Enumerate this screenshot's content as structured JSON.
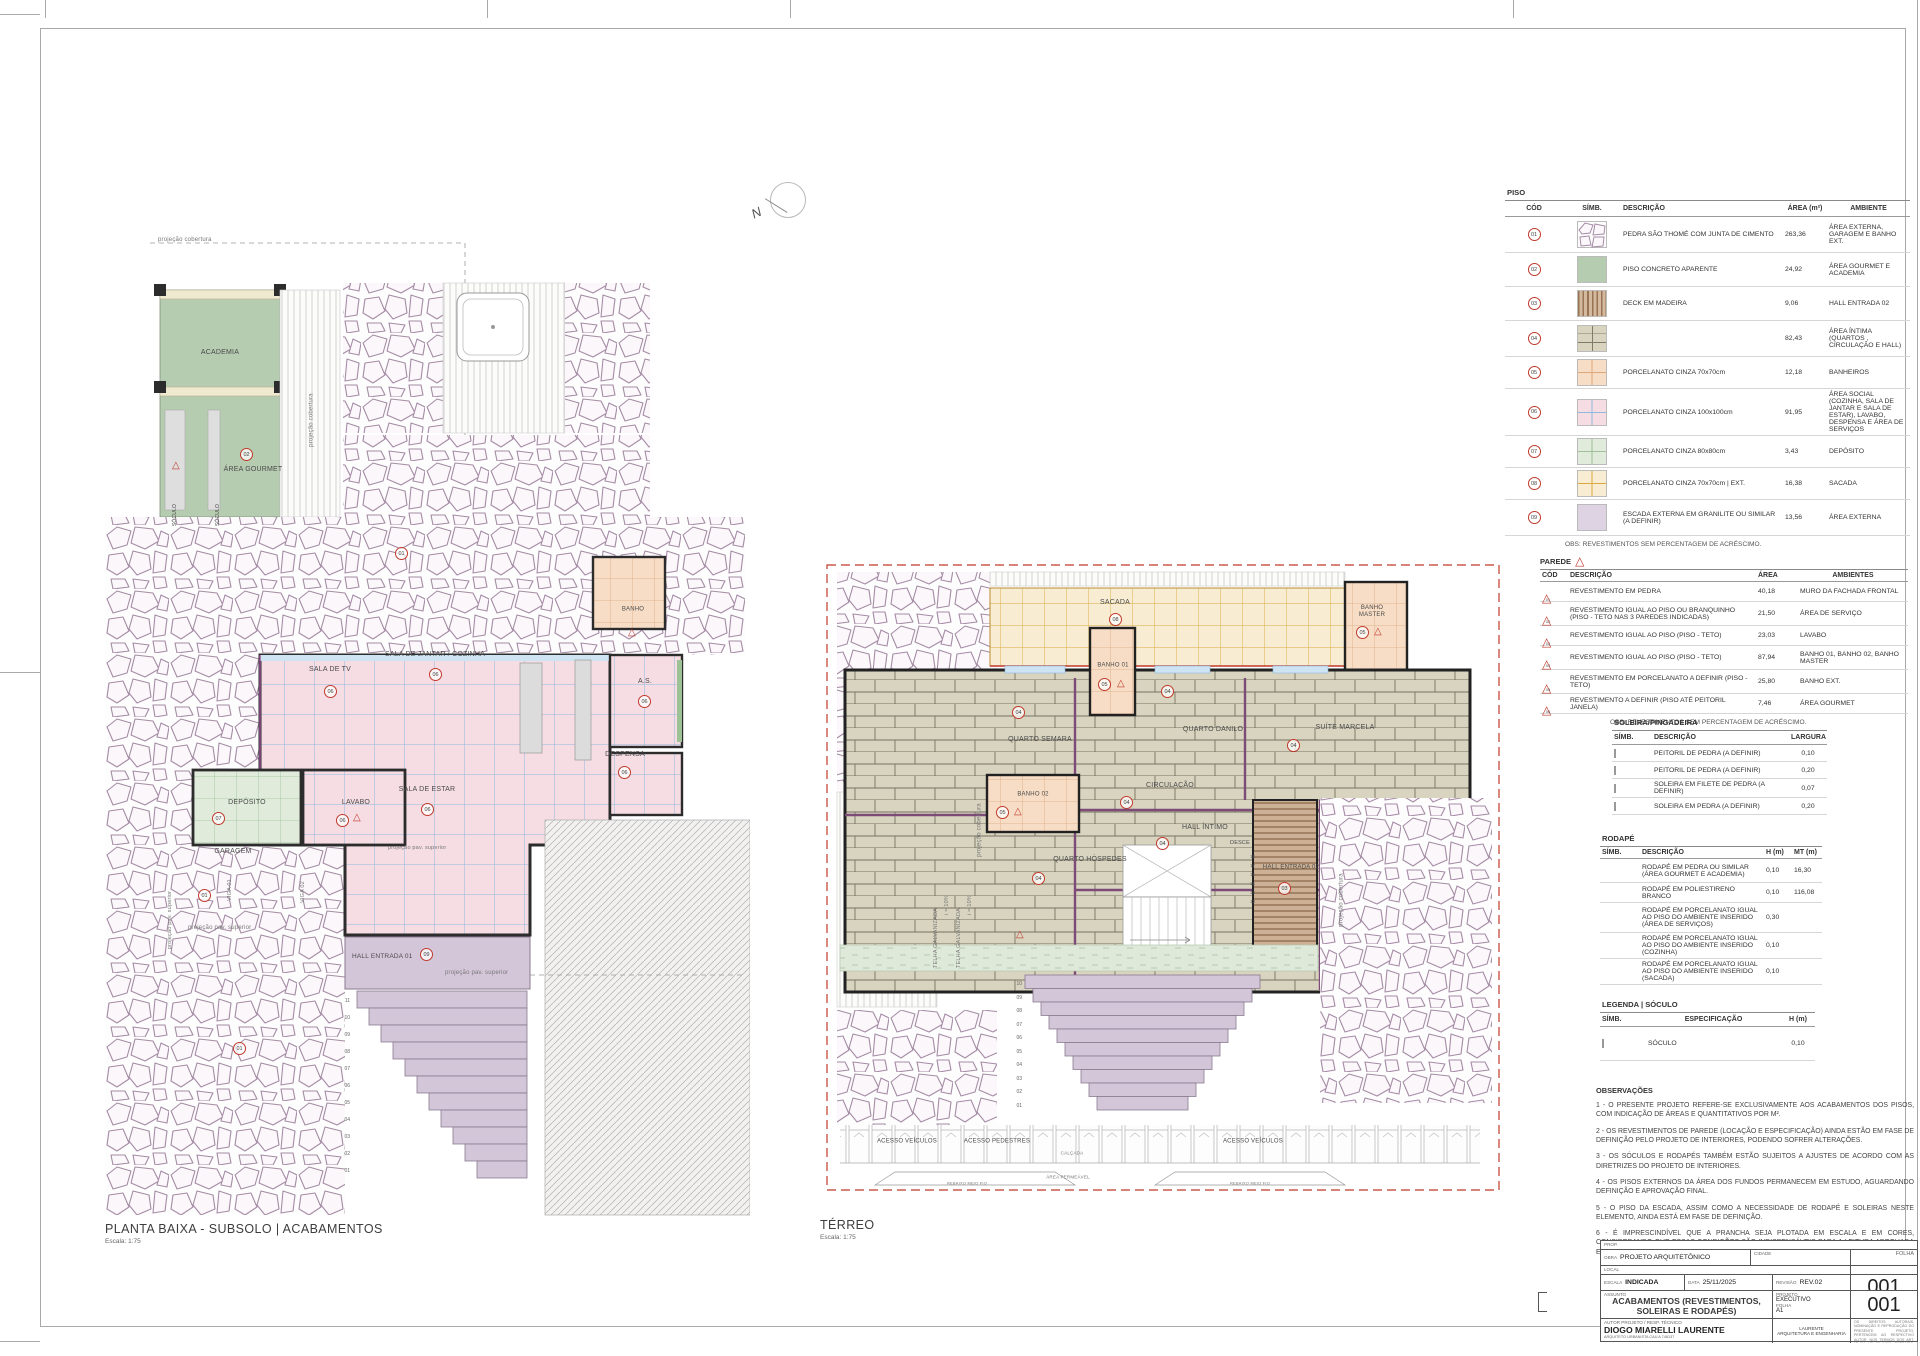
{
  "colors": {
    "accent_red": "#c0392b",
    "stone_line": "#a48ca4",
    "pink_floor": "#f5dde3",
    "green_floor": "#b6ccb1",
    "yellow_floor": "#f8edd2",
    "peach_floor": "#f7ddc5",
    "wood_floor": "#d8d4c0",
    "purple_stair": "#d4c6d9"
  },
  "north": {
    "label": "N"
  },
  "codes": {
    "c01": "01",
    "c02": "02",
    "c03": "03",
    "c04": "04",
    "c05": "05",
    "c06": "06",
    "c07": "07",
    "c08": "08",
    "c09": "09"
  },
  "piso": {
    "title": "PISO",
    "columns": [
      "CÓD",
      "SÍMB.",
      "DESCRIÇÃO",
      "ÁREA (m²)",
      "AMBIENTE"
    ],
    "rows": [
      {
        "cod": "01",
        "desc": "PEDRA SÃO THOMÉ COM JUNTA DE CIMENTO",
        "area": "263,36",
        "amb": "ÁREA EXTERNA, GARAGEM E BANHO EXT."
      },
      {
        "cod": "02",
        "desc": "PISO CONCRETO APARENTE",
        "area": "24,92",
        "amb": "ÁREA GOURMET E ACADEMIA"
      },
      {
        "cod": "03",
        "desc": "DECK EM MADEIRA",
        "area": "9,06",
        "amb": "HALL ENTRADA 02"
      },
      {
        "cod": "04",
        "desc": "PISO VINÍLICO TIPO TÁBUAS DE MADEIRA MÉDIA",
        "area": "82,43",
        "amb": "ÁREA ÍNTIMA (QUARTOS , CIRCULAÇÃO E HALL)"
      },
      {
        "cod": "05",
        "desc": "PORCELANATO CINZA 70x70cm",
        "area": "12,18",
        "amb": "BANHEIROS"
      },
      {
        "cod": "06",
        "desc": "PORCELANATO CINZA 100x100cm",
        "area": "91,95",
        "amb": "ÁREA SOCIAL (COZINHA, SALA DE JANTAR E SALA DE ESTAR), LAVABO, DESPENSA E ÁREA DE SERVIÇOS"
      },
      {
        "cod": "07",
        "desc": "PORCELANATO CINZA 80x80cm",
        "area": "3,43",
        "amb": "DEPÓSITO"
      },
      {
        "cod": "08",
        "desc": "PORCELANATO CINZA 70x70cm | EXT.",
        "area": "16,38",
        "amb": "SACADA"
      },
      {
        "cod": "09",
        "desc": "ESCADA EXTERNA EM GRANILITE OU SIMILAR (A DEFINIR)",
        "area": "13,56",
        "amb": "ÁREA EXTERNA"
      }
    ],
    "obs": "OBS: REVESTIMENTOS SEM PERCENTAGEM DE ACRÉSCIMO."
  },
  "parede": {
    "title": "PAREDE",
    "columns": [
      "CÓD",
      "DESCRIÇÃO",
      "ÁREA",
      "AMBIENTES"
    ],
    "rows": [
      {
        "cod": "01",
        "desc": "REVESTIMENTO EM PEDRA",
        "area": "40,18",
        "amb": "MURO DA FACHADA FRONTAL"
      },
      {
        "cod": "02",
        "desc": "REVESTIMENTO IGUAL AO PISO OU BRANQUINHO  (PISO - TETO NAS 3 PAREDES INDICADAS)",
        "area": "21,50",
        "amb": "ÁREA DE SERVIÇO"
      },
      {
        "cod": "03",
        "desc": "REVESTIMENTO IGUAL AO PISO (PISO - TETO)",
        "area": "23,03",
        "amb": "LAVABO"
      },
      {
        "cod": "04",
        "desc": "REVESTIMENTO IGUAL AO PISO (PISO - TETO)",
        "area": "87,94",
        "amb": "BANHO 01, BANHO 02, BANHO MASTER"
      },
      {
        "cod": "05",
        "desc": "REVESTIMENTO EM PORCELANATO A DEFINIR  (PISO - TETO)",
        "area": "25,80",
        "amb": "BANHO EXT."
      },
      {
        "cod": "06",
        "desc": "REVESTIMENTO A DEFINIR (PISO ATÉ PEITORIL JANELA)",
        "area": "7,46",
        "amb": "ÁREA GOURMET"
      }
    ],
    "obs": "OBS: REVESTIMENTOS SEM PERCENTAGEM DE ACRÉSCIMO."
  },
  "soleira": {
    "title": "SOLEIRA/PINGADEIRA",
    "columns": [
      "SÍMB.",
      "DESCRIÇÃO",
      "LARGURA"
    ],
    "rows": [
      {
        "desc": "PEITORIL DE PEDRA (A DEFINIR)",
        "larg": "0,10"
      },
      {
        "desc": "PEITORIL DE PEDRA (A DEFINIR)",
        "larg": "0,20"
      },
      {
        "desc": "SOLEIRA EM FILETE DE PEDRA (A DEFINIR)",
        "larg": "0,07"
      },
      {
        "desc": "SOLEIRA EM PEDRA (A DEFINIR)",
        "larg": "0,20"
      }
    ]
  },
  "rodape": {
    "title": "RODAPÉ",
    "columns": [
      "SÍMB.",
      "DESCRIÇÃO",
      "H (m)",
      "MT (m)"
    ],
    "rows": [
      {
        "desc": "RODAPÉ EM PEDRA OU SIMILAR (ÁREA GOURMET E ACADEMIA)",
        "h": "0,10",
        "mt": "16,30"
      },
      {
        "desc": "RODAPÉ EM POLIESTIRENO BRANCO",
        "h": "0,10",
        "mt": "116,08"
      },
      {
        "desc": "RODAPÉ EM PORCELANATO IGUAL AO PISO DO AMBIENTE INSERIDO  (ÁREA DE SERVIÇOS)",
        "h": "0,30",
        "mt": ""
      },
      {
        "desc": "RODAPÉ EM PORCELANATO IGUAL AO PISO DO AMBIENTE INSERIDO  (COZINHA)",
        "h": "0,10",
        "mt": ""
      },
      {
        "desc": "RODAPÉ EM PORCELANATO IGUAL AO PISO DO AMBIENTE INSERIDO (SACADA)",
        "h": "0,10",
        "mt": ""
      }
    ]
  },
  "soculo": {
    "title": "LEGENDA | SÓCULO",
    "columns": [
      "SÍMB.",
      "ESPECIFICAÇÃO",
      "H (m)"
    ],
    "rows": [
      {
        "desc": "SÓCULO",
        "h": "0,10"
      }
    ]
  },
  "observacoes": {
    "title": "OBSERVAÇÕES",
    "items": [
      "1 - O PRESENTE PROJETO REFERE-SE EXCLUSIVAMENTE AOS ACABAMENTOS DOS PISOS, COM INDICAÇÃO DE ÁREAS E QUANTITATIVOS POR M².",
      "2 - OS REVESTIMENTOS DE PAREDE (LOCAÇÃO E ESPECIFICAÇÃO) AINDA ESTÃO EM FASE DE DEFINIÇÃO PELO PROJETO DE INTERIORES, PODENDO SOFRER ALTERAÇÕES.",
      "3 - OS SÓCULOS E RODAPÉS TAMBÉM ESTÃO SUJEITOS A AJUSTES DE ACORDO COM AS DIRETRIZES DO PROJETO DE INTERIORES.",
      "4 - OS PISOS EXTERNOS DA ÁREA DOS FUNDOS PERMANECEM EM ESTUDO, AGUARDANDO DEFINIÇÃO E APROVAÇÃO FINAL.",
      "5 - O PISO DA ESCADA, ASSIM COMO A NECESSIDADE DE RODAPÉ E SOLEIRAS NESTE ELEMENTO, AINDA ESTÁ EM FASE DE DEFINIÇÃO.",
      "6 - É IMPRESCINDÍVEL QUE A PRANCHA SEJA PLOTADA EM ESCALA E EM CORES, CONSIDERANDO QUE ESSAS CONDIÇÕES SÃO INDISPENSÁVEIS PARA A LEITURA ADEQUADA E COMPREENSÃO CORRETA DOS DETALHAMENTOS."
    ]
  },
  "titleblock": {
    "prop": "PROP.",
    "obra_label": "OBRA",
    "obra": "PROJETO ARQUITETÔNICO",
    "cidade_label": "CIDADE",
    "folha_label": "FOLHA",
    "local_label": "LOCAL",
    "escala_label": "ESCALA",
    "escala": "INDICADA",
    "data_label": "DATA",
    "data": "25/11/2025",
    "revisao_label": "REVISÃO",
    "revisao": "REV.02",
    "assunto_label": "ASSUNTO",
    "assunto": "ACABAMENTOS (REVESTIMENTOS, SOLEIRAS E RODAPÉS)",
    "projeto_label": "PROJETO",
    "projeto": "EXECUTIVO",
    "folha2_label": "FOLHA",
    "folha2": "A1",
    "autor_label": "AUTOR PROJETO / RESP. TÉCNICO",
    "autor": "DIOGO MIARELLI LAURENTE",
    "autor_sub": "ARQUITETO URBANISTA CAU A 748137",
    "empresa": "LAURENTE\nARQUITETURA E ENGENHARIA",
    "sheet_num1": "001",
    "sheet_num2": "001",
    "disclaimer": "OS DIREITOS AUTORAIS, NOMINAÇÃO E REPRODUÇÃO DO PRESENTE PROJETO, PERTENCEM AO RESPECTIVO AUTOR, NOS TERMOS DOS ART. Nº DA LEI Nº 9.610. EXTRAÍDO, PORTANTO, VEDADO A SUA REPRODUÇÃO E/OU ALTERAÇÃO TOTAL OU PARCIAL."
  },
  "plans": {
    "subsolo": {
      "title": "PLANTA BAIXA - SUBSOLO | ACABAMENTOS",
      "scale": "Escala: 1:75",
      "labels": {
        "proj_cobertura": "projeção cobertura",
        "academia": "ACADEMIA",
        "area_gourmet": "ÁREA GOURMET",
        "soculo": "SÓCULO",
        "sala_jantar": "SALA DE JANTAR / COZINHA",
        "sala_tv": "SALA DE TV",
        "sala_estar": "SALA DE  ESTAR",
        "as": "A.S.",
        "banho": "BANHO",
        "despensa": "DESPENSA",
        "deposito": "DEPÓSITO",
        "lavabo": "LAVABO",
        "garagem": "GARAGEM",
        "viga01": "VIGA 01",
        "viga02": "VIGA 02",
        "proj_pav": "projeção pav. superior",
        "hall": "HALL ENTRADA 01",
        "steps": "11\n10\n09\n08\n07\n06\n05\n04\n03\n02\n01"
      }
    },
    "terreo": {
      "title": "TÉRREO",
      "scale": "Escala: 1:75",
      "labels": {
        "sacada": "SACADA",
        "banho_master": "BANHO\nMASTER",
        "banho01": "BANHO 01",
        "banho02": "BANHO 02",
        "quarto_semara": "QUARTO SEMARA",
        "quarto_danilo": "QUARTO DANILO",
        "suite_marcela": "SUÍTE MARCELA",
        "circulacao": "CIRCULAÇÃO",
        "quarto_hospedes": "QUARTO HÓSPEDES",
        "hall_intimo": "HALL ÍNTIMO",
        "desce": "DESCE",
        "hall02": "HALL ENTRADA 02",
        "telha": "TELHA GALVANIZADA",
        "incl": "i = 10%",
        "proj_cobertura": "projeção cobertura",
        "acesso_veiculos": "ACESSO VEÍCULOS",
        "acesso_pedestres": "ACESSO PEDESTRES",
        "calcada": "CALÇADA",
        "area_permeavel": "ÁREA PERMEÁVEL",
        "rebaixo": "REBAIXO MEIO FIO",
        "steps_desce": "18\n17\n16\n15\n14\n13",
        "steps_ext": "10\n09\n08\n07\n06\n05\n04\n03\n02\n01"
      }
    }
  }
}
